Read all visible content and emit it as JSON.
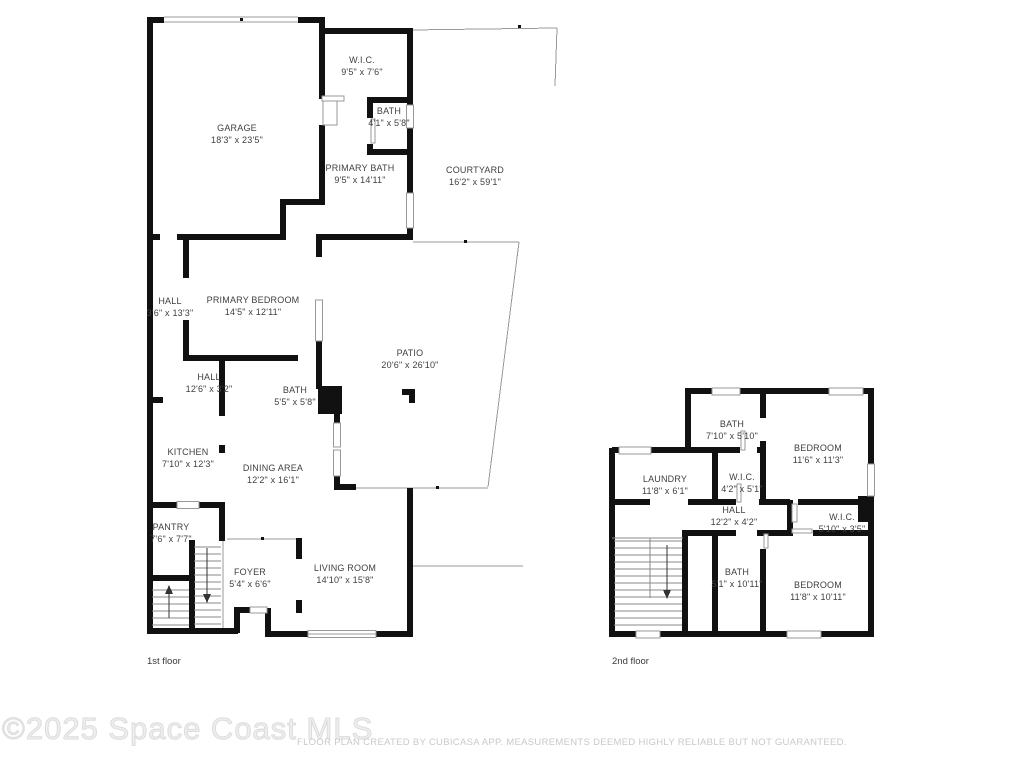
{
  "watermark": {
    "text": "©2025 Space Coast MLS"
  },
  "disclaimer": "FLOOR PLAN CREATED BY CUBICASA APP. MEASUREMENTS DEEMED HIGHLY RELIABLE BUT NOT GUARANTEED.",
  "colors": {
    "wall": "#111111",
    "thin_line": "#999999",
    "room_text": "#3f3f3f",
    "floor_label": "#3a3a3a",
    "watermark": "#e9e9e9",
    "disclaimer": "#c9c9c9"
  },
  "floors": [
    {
      "label": "1st floor",
      "rooms": [
        {
          "name": "GARAGE",
          "dims": "18'3\" x 23'5\""
        },
        {
          "name": "W.I.C.",
          "dims": "9'5\" x 7'6\""
        },
        {
          "name": "BATH",
          "dims": "4'1\" x 5'8\""
        },
        {
          "name": "PRIMARY BATH",
          "dims": "9'5\" x 14'11\""
        },
        {
          "name": "COURTYARD",
          "dims": "16'2\" x 59'1\""
        },
        {
          "name": "PRIMARY BEDROOM",
          "dims": "14'5\" x 12'11\""
        },
        {
          "name": "HALL",
          "dims": "3'6\" x 13'3\""
        },
        {
          "name": "HALL",
          "dims": "12'6\" x 3'2\""
        },
        {
          "name": "BATH",
          "dims": "5'5\" x 5'8\""
        },
        {
          "name": "PATIO",
          "dims": "20'6\" x 26'10\""
        },
        {
          "name": "KITCHEN",
          "dims": "7'10\" x 12'3\""
        },
        {
          "name": "DINING AREA",
          "dims": "12'2\" x 16'1\""
        },
        {
          "name": "PANTRY",
          "dims": "7'6\" x 7'7\""
        },
        {
          "name": "FOYER",
          "dims": "5'4\" x 6'6\""
        },
        {
          "name": "LIVING ROOM",
          "dims": "14'10\" x 15'8\""
        }
      ]
    },
    {
      "label": "2nd floor",
      "rooms": [
        {
          "name": "BATH",
          "dims": "7'10\" x 5'10\""
        },
        {
          "name": "BEDROOM",
          "dims": "11'6\" x 11'3\""
        },
        {
          "name": "LAUNDRY",
          "dims": "11'8\" x 6'1\""
        },
        {
          "name": "W.I.C.",
          "dims": "4'2\" x 5'1\""
        },
        {
          "name": "HALL",
          "dims": "12'2\" x 4'2\""
        },
        {
          "name": "W.I.C.",
          "dims": "5'10\" x 3'5\""
        },
        {
          "name": "BATH",
          "dims": "5'1\" x 10'11\""
        },
        {
          "name": "BEDROOM",
          "dims": "11'8\" x 10'11\""
        }
      ]
    }
  ]
}
